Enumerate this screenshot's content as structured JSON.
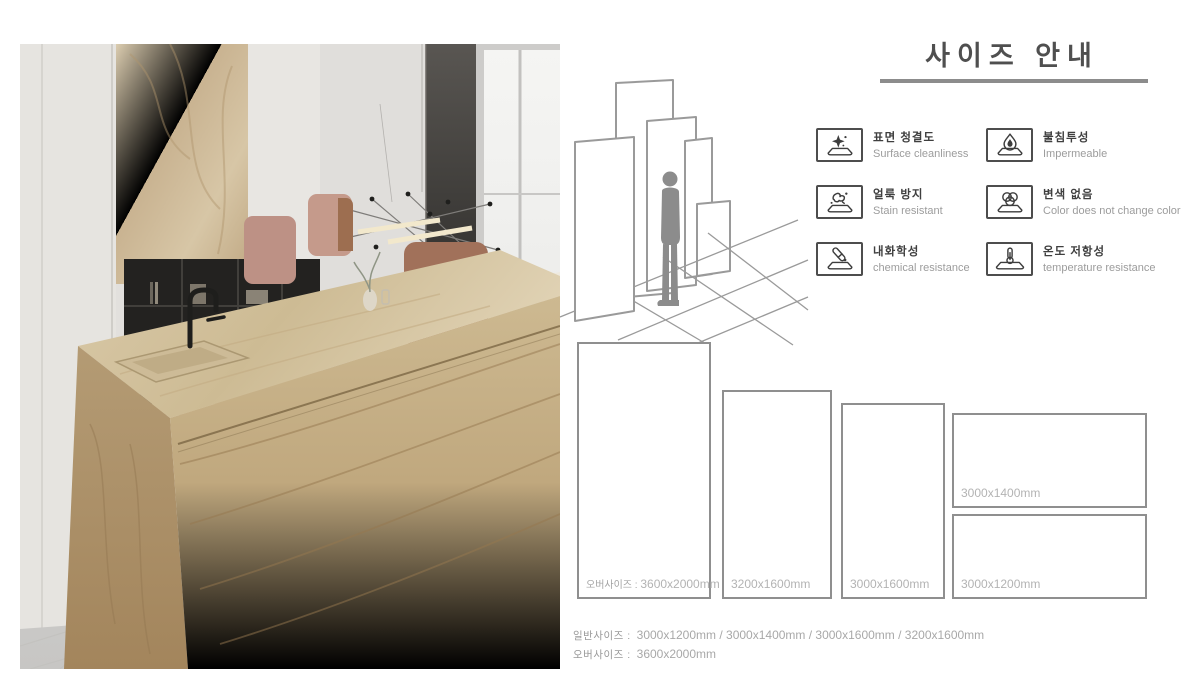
{
  "header": {
    "title": "사이즈 안내"
  },
  "features": [
    {
      "ko": "표면 청결도",
      "en": "Surface cleanliness",
      "icon": "sparkle-surface-icon"
    },
    {
      "ko": "불침투성",
      "en": "Impermeable",
      "icon": "water-drop-icon"
    },
    {
      "ko": "얼룩 방지",
      "en": "Stain resistant",
      "icon": "stain-splash-icon"
    },
    {
      "ko": "변색 없음",
      "en": "Color does not change color",
      "icon": "color-wheel-icon"
    },
    {
      "ko": "내화학성",
      "en": "chemical resistance",
      "icon": "test-tube-icon"
    },
    {
      "ko": "온도 저항성",
      "en": "temperature resistance",
      "icon": "thermometer-icon"
    }
  ],
  "size_slabs": [
    {
      "prefix": "오버사이즈 : ",
      "dimension": "3600x2000mm"
    },
    {
      "prefix": "",
      "dimension": "3200x1600mm"
    },
    {
      "prefix": "",
      "dimension": "3000x1600mm"
    },
    {
      "prefix": "",
      "dimension": "3000x1400mm"
    },
    {
      "prefix": "",
      "dimension": "3000x1200mm"
    }
  ],
  "summary": [
    {
      "label": "일반사이즈 :",
      "value": "3000x1200mm / 3000x1400mm / 3000x1600mm / 3200x1600mm"
    },
    {
      "label": "오버사이즈 :",
      "value": "3600x2000mm"
    }
  ],
  "colors": {
    "accent_line": "#8c8c8c",
    "slab_border": "#8f8f8f",
    "title_text": "#4f4f4f"
  }
}
